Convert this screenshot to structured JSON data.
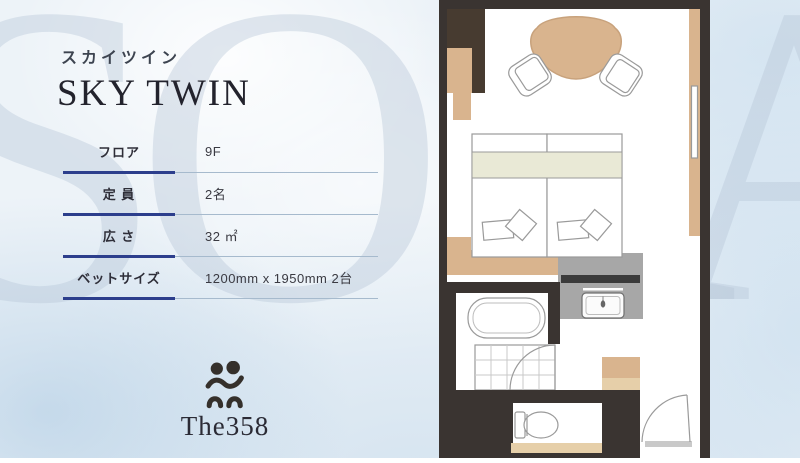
{
  "page": {
    "room_name_ja": "スカイツイン",
    "room_name_en": "SKY TWIN"
  },
  "specs": {
    "rows": [
      {
        "label": "フロア",
        "value": "9F"
      },
      {
        "label": "定 員",
        "value": "2名"
      },
      {
        "label": "広 さ",
        "value": "32 ㎡"
      },
      {
        "label": "ベットサイズ",
        "value": "1200mm x 1950mm 2台"
      }
    ]
  },
  "logo": {
    "text": "The358",
    "icon": "two-people-icon"
  },
  "background": {
    "watermark": "SORA",
    "letters": [
      "S",
      "O",
      "R",
      "A"
    ]
  },
  "floor_plan": {
    "name": "sky-twin-floor-plan",
    "features": [
      "entry-door",
      "toilet",
      "bathtub",
      "shower-room",
      "vanity-sink",
      "twin-beds",
      "pillows",
      "headboard-shelf",
      "luggage-bench",
      "closet",
      "triangular-table",
      "lounge-chairs",
      "window-counter"
    ]
  },
  "colors": {
    "accent_navy": "#2c3e8c",
    "bg_blue": "#edf3f8",
    "wall_dark": "#3a3431",
    "closet_dark": "#473b30",
    "wood_beige": "#d9b48e",
    "wood_light": "#e6cfa9",
    "bed_sage": "#e9e9d6",
    "counter_gray": "#a7a7a7",
    "line_gray": "#9a9a9a",
    "text_dark": "#23232d"
  }
}
